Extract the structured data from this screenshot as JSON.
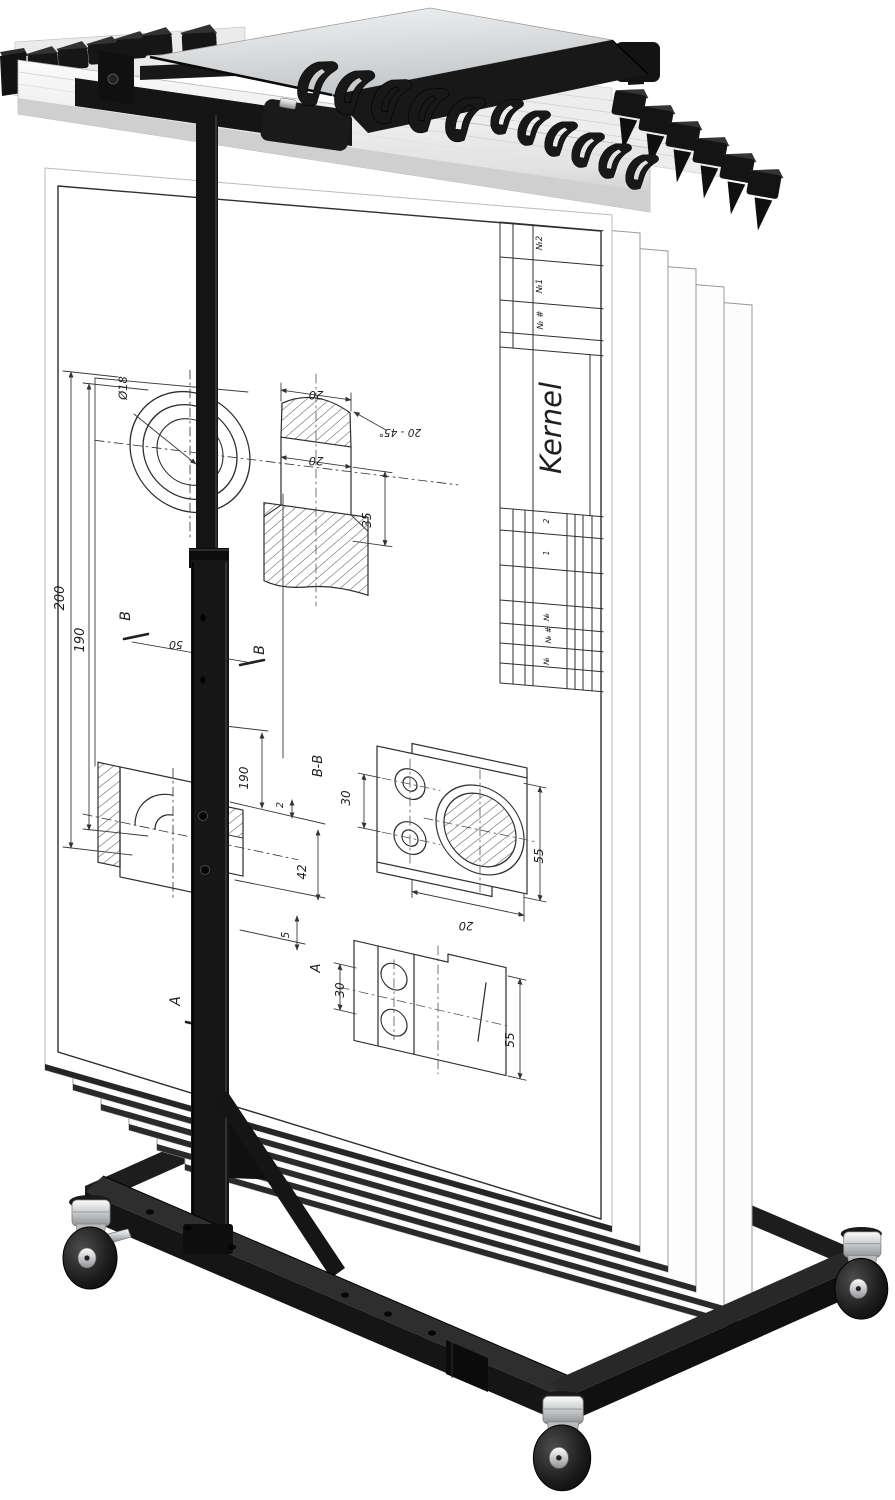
{
  "product": {
    "type": "Mobile blueprint holder stand with hanging engineering drawings",
    "colors": {
      "frame_black": "#161616",
      "rail_silver": "#e9e9e9",
      "tray_silver": "#d8dadc",
      "sheet_white": "#ffffff",
      "wheel_black": "#111111",
      "chrome": "#cccccc"
    }
  },
  "sheet": {
    "title_block": {
      "part_name": "Kernel",
      "rev_labels": [
        "№2",
        "№1",
        "№ #"
      ],
      "row_labels": [
        "2",
        "1",
        "№",
        "№ #",
        "№"
      ]
    },
    "dims": {
      "ring_dia": "Ø18",
      "h200": "200",
      "h190": "190",
      "w20_top": "20",
      "chamfer": "20 - 45°",
      "w20_mid": "20",
      "h35": "35",
      "b1": "B",
      "b2": "B",
      "span50": "50",
      "g3_190": "190",
      "g3_2": "2",
      "g3_42": "42",
      "g3_5": "5",
      "bb_label": "B-B",
      "bb_30": "30",
      "bb_55": "55",
      "bb_20": "20",
      "a_mark": "A",
      "a_view": "A",
      "a_30": "30",
      "a_55": "55"
    }
  }
}
